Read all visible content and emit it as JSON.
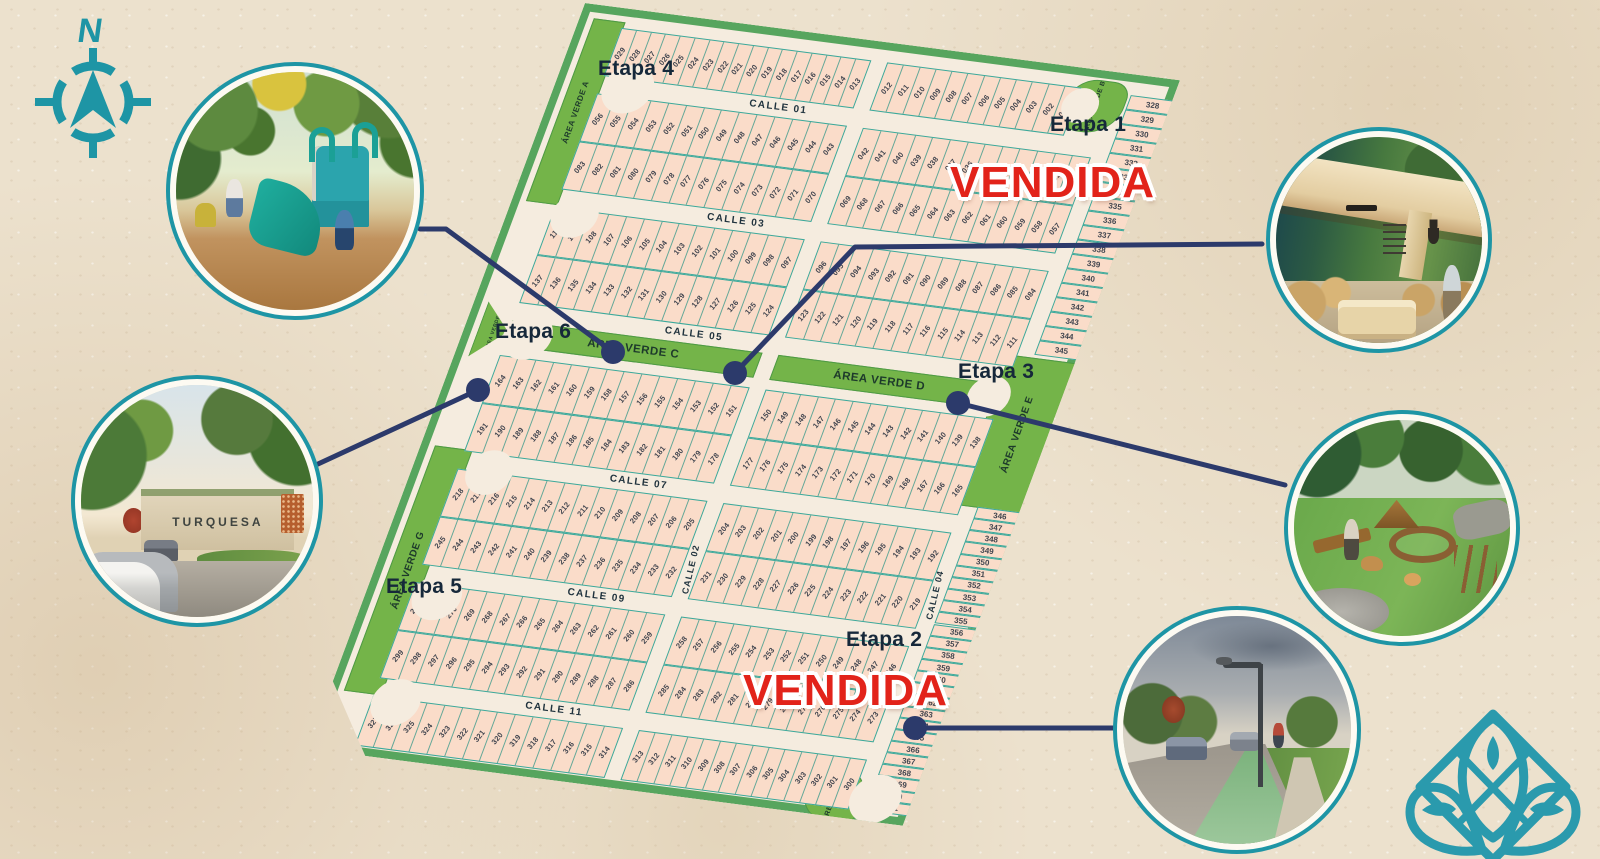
{
  "compass": {
    "north_label": "N"
  },
  "map": {
    "sold_label": "VENDIDA",
    "etapas": [
      {
        "id": "etapa-4",
        "label": "Etapa 4",
        "sold": false
      },
      {
        "id": "etapa-1",
        "label": "Etapa 1",
        "sold": true
      },
      {
        "id": "etapa-6",
        "label": "Etapa 6",
        "sold": false
      },
      {
        "id": "etapa-3",
        "label": "Etapa 3",
        "sold": false
      },
      {
        "id": "etapa-5",
        "label": "Etapa 5",
        "sold": false
      },
      {
        "id": "etapa-2",
        "label": "Etapa 2",
        "sold": true
      }
    ],
    "bands": [
      {
        "type": "lots",
        "left": [
          29,
          13
        ],
        "right": [
          12,
          1
        ]
      },
      {
        "type": "street",
        "label": "CALLE 01"
      },
      {
        "type": "lots",
        "left": [
          56,
          43
        ],
        "right": [
          42,
          30
        ]
      },
      {
        "type": "lots",
        "left": [
          83,
          70
        ],
        "right": [
          69,
          57
        ]
      },
      {
        "type": "street",
        "label": "CALLE 03"
      },
      {
        "type": "lots",
        "left": [
          110,
          97
        ],
        "right": [
          96,
          84
        ]
      },
      {
        "type": "lots",
        "left": [
          137,
          124
        ],
        "right": [
          123,
          111
        ]
      },
      {
        "type": "street",
        "label": "CALLE 05"
      },
      {
        "type": "green"
      },
      {
        "type": "lots",
        "left": [
          164,
          151
        ],
        "right": [
          150,
          138
        ]
      },
      {
        "type": "lots",
        "left": [
          191,
          178
        ],
        "right": [
          177,
          165
        ]
      },
      {
        "type": "street",
        "label": "CALLE 07"
      },
      {
        "type": "lots",
        "left": [
          218,
          205
        ],
        "right": [
          204,
          192
        ]
      },
      {
        "type": "lots",
        "left": [
          245,
          232
        ],
        "right": [
          231,
          219
        ]
      },
      {
        "type": "street",
        "label": "CALLE 09"
      },
      {
        "type": "lots",
        "left": [
          272,
          259
        ],
        "right": [
          258,
          246
        ]
      },
      {
        "type": "lots",
        "left": [
          299,
          286
        ],
        "right": [
          285,
          273
        ]
      },
      {
        "type": "street",
        "label": "CALLE 11"
      },
      {
        "type": "lots",
        "left": [
          327,
          314
        ],
        "right": [
          313,
          300
        ]
      }
    ],
    "vertical_streets": [
      {
        "label": "CALLE 02"
      },
      {
        "label": "CALLE 04"
      }
    ],
    "right_column": {
      "top_from": 328,
      "top_to": 345,
      "bottom_from": 346,
      "bottom_to": 371
    },
    "green_areas": {
      "a": "ÁREA VERDE A",
      "b": "ÁREA VERDE B",
      "c": "ÁREA VERDE C",
      "d": "ÁREA VERDE D",
      "e": "ÁREA VERDE E",
      "f": "ÁREA VERDE F",
      "g": "ÁREA VERDE G",
      "h": "ÁREA VERDE H"
    }
  },
  "photos": {
    "entrance_sign_text": "TURQUESA"
  },
  "colors": {
    "teal": "#1e95a5",
    "navy": "#2c3a6b",
    "red": "#e2231a",
    "green": "#74b449",
    "lot_fill": "#fadcc9",
    "lot_line": "#3aa99b",
    "street": "#f5ecdf",
    "background": "#ece1cd",
    "map_border": "#57a55e"
  }
}
